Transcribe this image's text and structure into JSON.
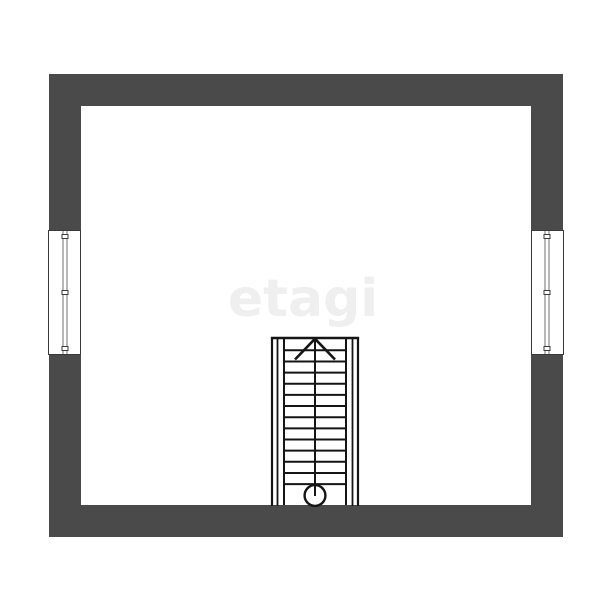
{
  "watermark": {
    "text": "etagi"
  },
  "colors": {
    "background": "#ffffff",
    "wall": "#4a4a4a",
    "stair_line": "#151515",
    "window_frame": "#3a3a3a",
    "window_glazing": "#707070",
    "watermark": "#efefef"
  },
  "plan": {
    "type": "floor-plan",
    "room_count": 1,
    "walls": [
      "north",
      "south",
      "west",
      "east"
    ],
    "windows": [
      {
        "id": "left-window",
        "wall": "west",
        "panes": 2
      },
      {
        "id": "right-window",
        "wall": "east",
        "panes": 2
      }
    ],
    "staircase": {
      "location": "bottom-center",
      "direction": "up",
      "flights": 2,
      "tread_count": 13,
      "tread_start_y": 350.3,
      "tread_spacing": 11.15,
      "flight_left_x": 284,
      "flight_right_x": 346,
      "center_x": 315,
      "top_y": 338,
      "bottom_y": 506,
      "arrow": {
        "apex_x": 315,
        "apex_y": 338.8,
        "leg_dx": 20,
        "leg_dy": 20.7
      },
      "start_marker": {
        "shape": "circle",
        "cx": 315,
        "cy": 495.5,
        "r": 10.4
      }
    }
  }
}
